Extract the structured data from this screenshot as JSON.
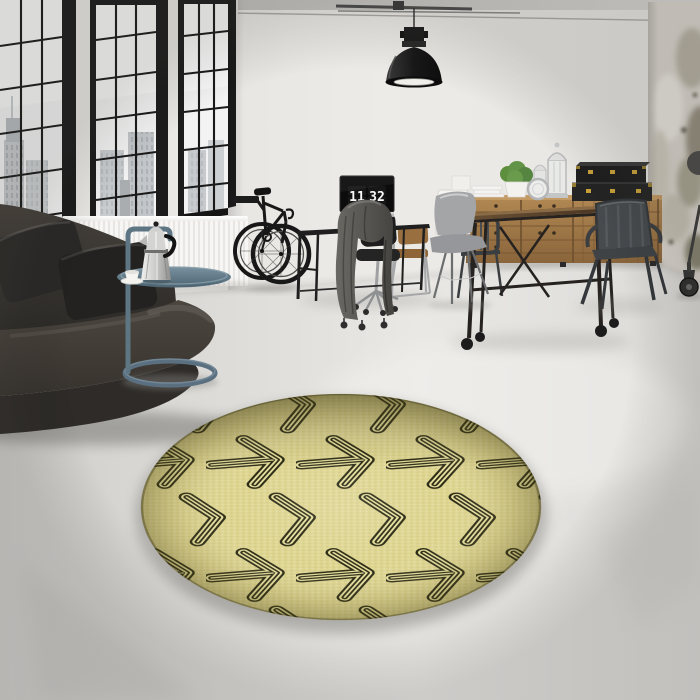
{
  "meta": {
    "title": "Loft interior product photo with round pale-yellow arrow-pattern rug",
    "scene_type": "interior product photograph"
  },
  "monitor": {
    "clock_hours": "11",
    "clock_minutes": "32"
  },
  "palette": {
    "rug_base": "#ded590",
    "rug_gap": "#e6df9d",
    "rug_arrow": "#2b2a14",
    "wall": "#eae8e4",
    "floor": "#e0dfdc",
    "window_frame": "#1c1c1c",
    "sofa_leather": "#3e3933",
    "side_table_blue": "#5e7584",
    "sideboard_wood": "#a47a48",
    "table_wood": "#5b452c",
    "metal_gunmetal": "#44484b",
    "brass": "#c9a23a",
    "plant_green": "#5d8f3f",
    "lamp_black": "#1d1d1d"
  },
  "rug": {
    "shape": "round",
    "motif": "right-pointing outlined arrows; rows alternate full arrows and bare chevrons, brick-offset",
    "base_color": "#ded590",
    "arrow_color": "#2b2a14"
  },
  "objects": [
    "industrial grid windows with city view",
    "white radiator",
    "dark leather sofa with cushions",
    "blue-grey tubular side table",
    "chrome moka pot",
    "white coffee cup",
    "black bicycle on wall mount",
    "black console desk",
    "monitor showing flip clock",
    "black office chair",
    "wooden office chair",
    "grey garment draped on casters",
    "black industrial pendant lamp",
    "ceiling conduit pipe",
    "wooden sideboard with drawers",
    "potted green plant",
    "white decorative lanterns",
    "stacked black trunks with brass latches",
    "industrial wood dining table on casters",
    "gunmetal tolix armchair",
    "gunmetal tolix side chair",
    "grey shell chair with wire base",
    "distressed concrete wall column",
    "rolling caster wheel",
    "round arrow-pattern rug"
  ]
}
